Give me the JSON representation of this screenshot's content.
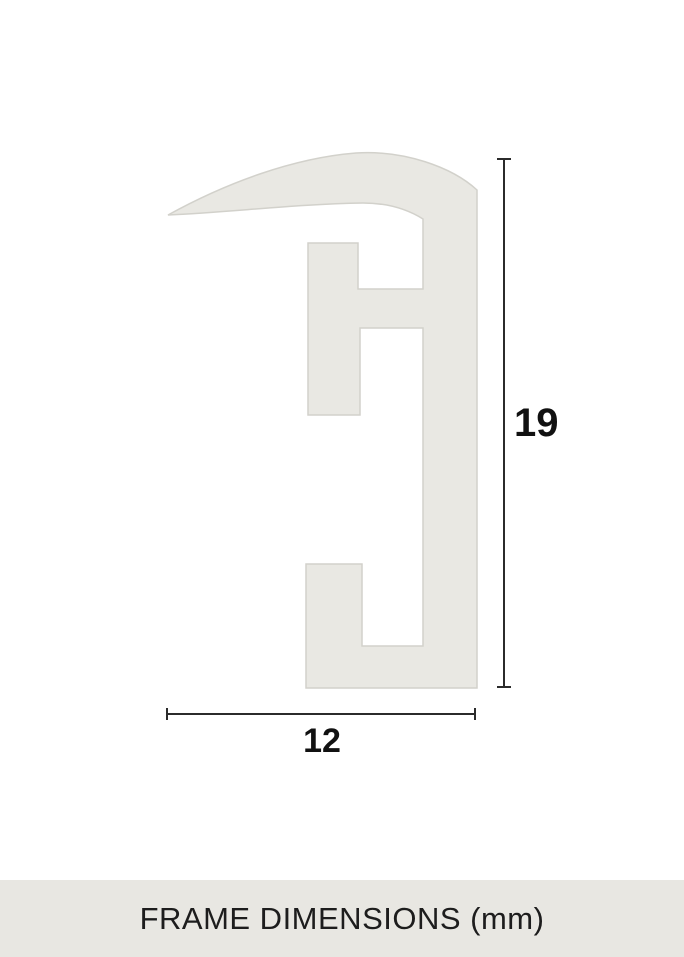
{
  "diagram": {
    "type": "technical-dimension-drawing",
    "subject": "picture-frame moulding profile cross-section",
    "height_label": "19",
    "width_label": "12",
    "dimensions": {
      "height_mm": 19,
      "width_mm": 12,
      "unit": "mm"
    }
  },
  "footer": {
    "caption": "FRAME DIMENSIONS (mm)"
  },
  "colors": {
    "background": "#ffffff",
    "shape_fill": "#e9e8e3",
    "shape_stroke": "#d2d1cb",
    "dimension_line": "#2b2b2b",
    "label_text": "#111111",
    "footer_background": "#e8e7e2",
    "footer_text": "#1d1d1d"
  }
}
